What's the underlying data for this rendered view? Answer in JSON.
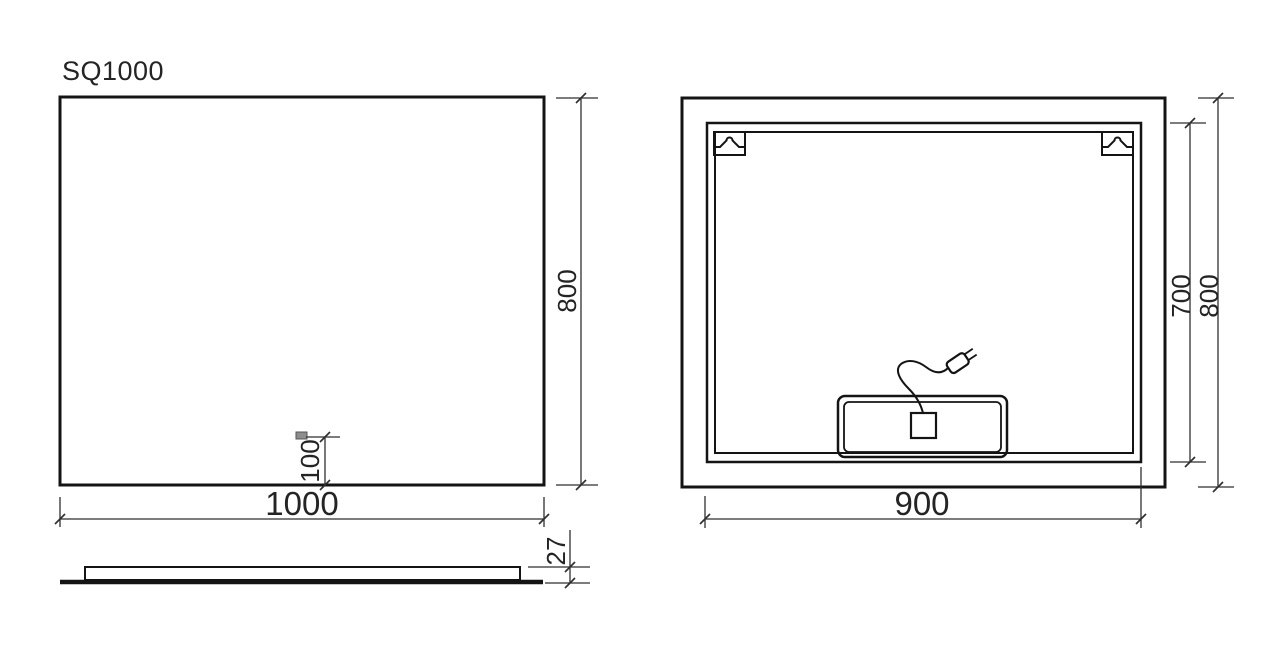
{
  "title": "SQ1000",
  "colors": {
    "background": "#ffffff",
    "line": "#141414",
    "dimension": "#2f2f2f",
    "text": "#242424",
    "sensor_fill": "#8d8d8d"
  },
  "front_view": {
    "width": "1000",
    "height": "800",
    "sensor_offset": "100"
  },
  "side_view": {
    "thickness": "27"
  },
  "back_view": {
    "frame_width": "900",
    "frame_height": "700",
    "height": "800"
  }
}
